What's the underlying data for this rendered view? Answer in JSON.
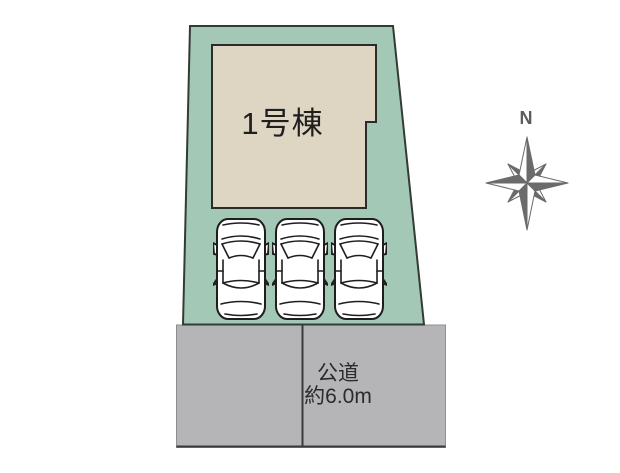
{
  "colors": {
    "plot_fill": "#a3c9b6",
    "plot_outline": "#333b35",
    "building_fill": "#ded5c3",
    "building_outline": "#2b2b2b",
    "road_fill": "#b5b5b7",
    "road_border": "#8f8f8f",
    "road_line_dark": "#3a3a3a",
    "compass_gray": "#6b6b6b"
  },
  "building": {
    "label": "1号棟"
  },
  "road": {
    "label_line1": "公道",
    "label_line2": "約6.0m"
  },
  "compass": {
    "north_label": "N"
  },
  "parking": {
    "car_count": 3
  }
}
